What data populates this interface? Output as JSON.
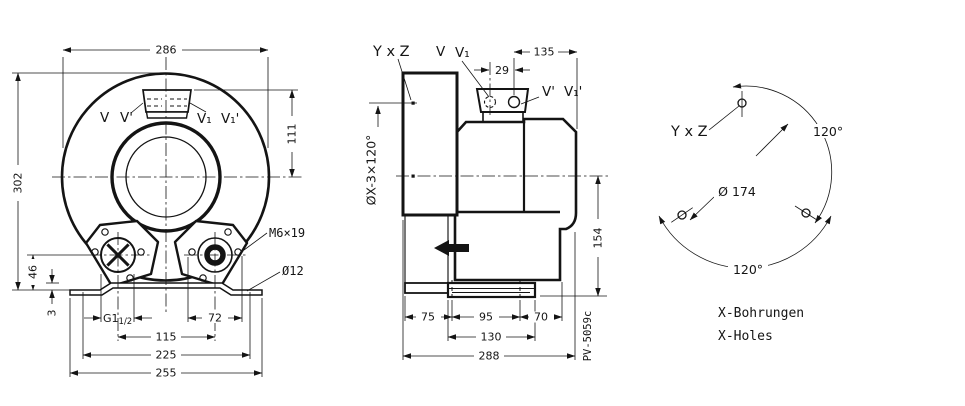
{
  "drawing": {
    "front_view": {
      "dims": {
        "overall_width": "286",
        "overall_height": "302",
        "port_center_height": "111",
        "foot_port_height": "46",
        "base_plate_thickness": "3",
        "port_thread_main": "G1",
        "port_thread_sub": "1/2",
        "foot_hole_spacing": "72",
        "foot_center_spacing": "115",
        "base_inner_width": "225",
        "base_overall_width": "255"
      },
      "labels": {
        "port_v": "V",
        "port_v_prime": "V'",
        "port_v1": "V₁",
        "port_v1_prime": "V₁'",
        "stud": "M6×19",
        "base_hole_dia": "Ø12"
      }
    },
    "side_view": {
      "dims": {
        "port_offset": "29",
        "port_to_edge": "135",
        "axis_to_base": "154",
        "seg_left": "75",
        "seg_mid": "95",
        "seg_right": "70",
        "foot_length": "130",
        "overall_length": "288"
      },
      "labels": {
        "cover_holes": "ØX-3×120°",
        "hole_pair": "Y x Z",
        "port_v": "V",
        "port_v1": "V₁",
        "port_v_prime": "V'",
        "port_v1_prime": "V₁'",
        "doc_number": "PV-5059c"
      }
    },
    "hole_pattern": {
      "labels": {
        "hole_pair": "Y x Z",
        "bolt_circle_dia": "Ø 174",
        "angle_right": "120°",
        "angle_bottom": "120°"
      },
      "legend": {
        "de": "X-Bohrungen",
        "en": "X-Holes"
      }
    }
  }
}
